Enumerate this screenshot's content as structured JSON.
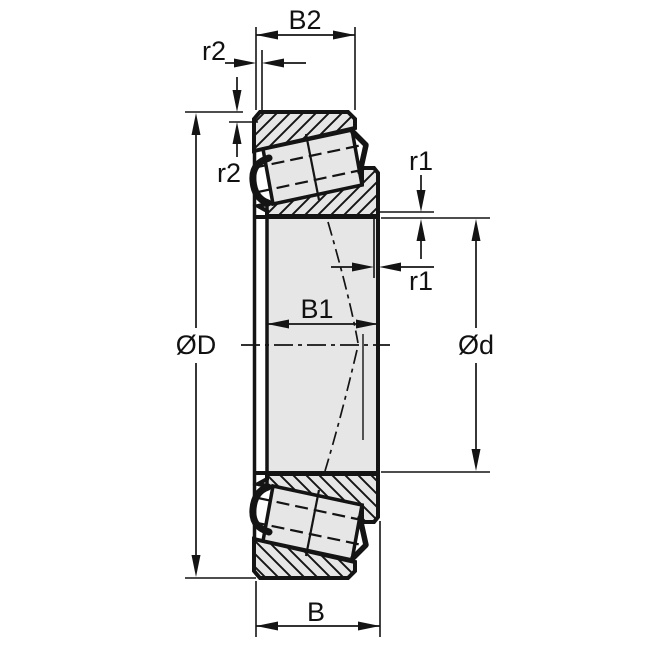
{
  "drawing": {
    "name": "tapered-roller-bearing-cross-section",
    "colors": {
      "line": "#141414",
      "part_fill": "#e6e6e6",
      "label_text": "#111111",
      "background": "#ffffff"
    },
    "labels": {
      "cup_width": "B2",
      "cup_chamfer_top": "r2",
      "cup_chamfer_side": "r2",
      "cone_chamfer_upper": "r1",
      "cone_chamfer_lower": "r1",
      "outer_diameter": "ØD",
      "bore_diameter": "Ød",
      "cone_width": "B1",
      "total_width": "B"
    }
  }
}
